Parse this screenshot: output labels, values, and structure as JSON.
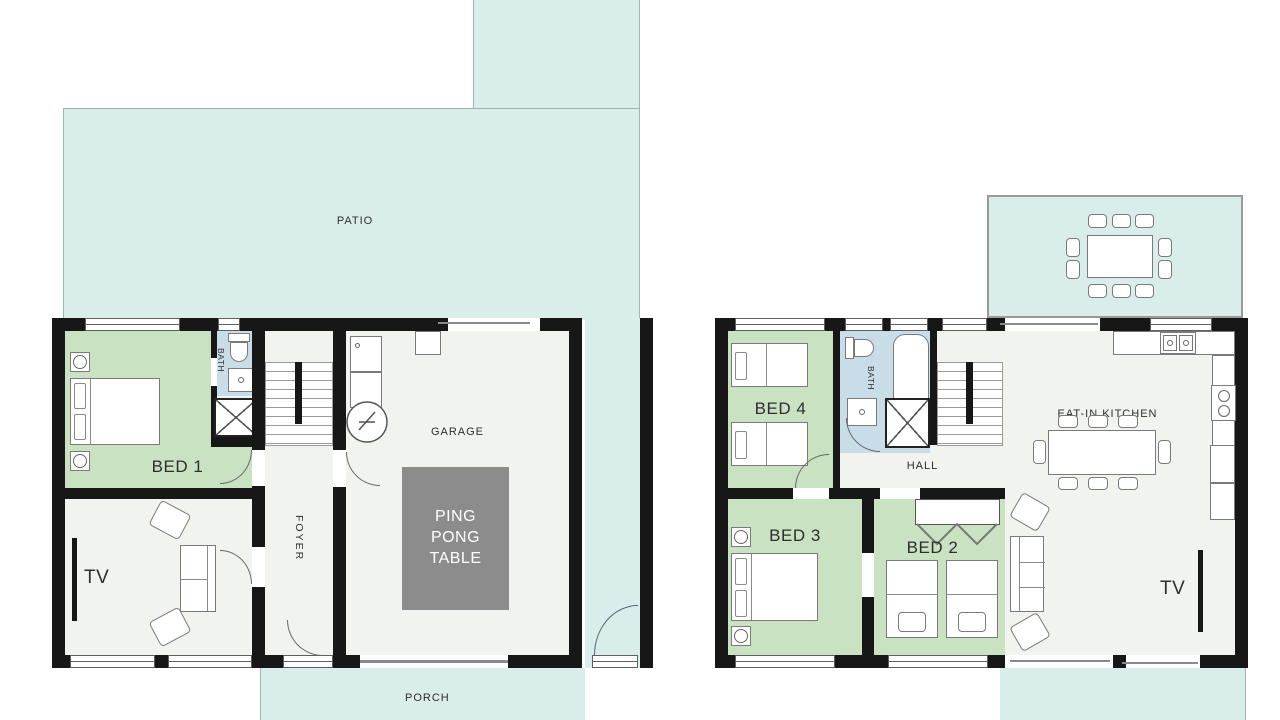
{
  "colors": {
    "outdoor": "#d9edeb",
    "outdoor_border": "#9bb7b4",
    "bedroom": "#c8e2c2",
    "bathroom": "#c9dde9",
    "floor": "#f1f4ee",
    "wall": "#171717",
    "table_gray": "#8c8c8c",
    "label": "#2e2e2e"
  },
  "floor1": {
    "patio_label": "PATIO",
    "bed1_label": "BED 1",
    "bath_label": "BATH",
    "foyer_label": "FOYER",
    "garage_label": "GARAGE",
    "ping_pong_label": "PING PONG TABLE",
    "tv_label": "TV",
    "porch_label": "PORCH"
  },
  "floor2": {
    "bed4_label": "BED 4",
    "bath_label": "BATH",
    "hall_label": "HALL",
    "kitchen_label": "EAT-IN KITCHEN",
    "bed3_label": "BED 3",
    "bed2_label": "BED 2",
    "tv_label": "TV"
  }
}
